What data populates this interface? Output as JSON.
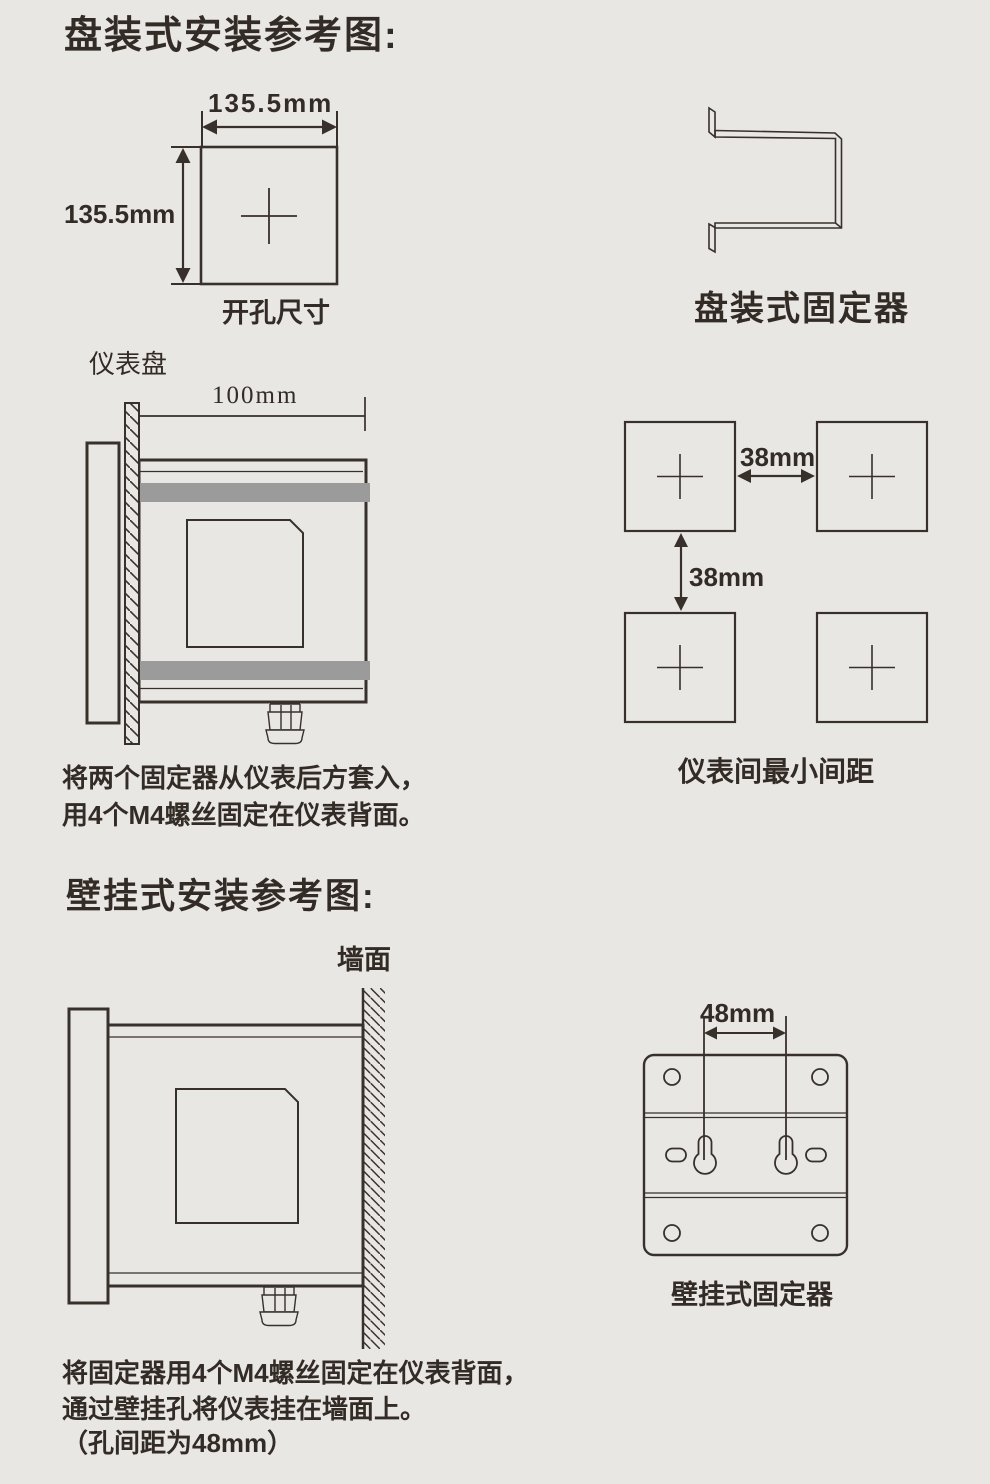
{
  "page": {
    "background": "#e9e7e4",
    "line_color": "#38302b",
    "bracket_bar_color": "#9b9b9b"
  },
  "panel_mount": {
    "title": "盘装式安装参考图:",
    "cutout": {
      "width": "135.5mm",
      "height": "135.5mm",
      "caption": "开孔尺寸"
    },
    "fixer_caption": "盘装式固定器",
    "side_view": {
      "panel_label": "仪表盘",
      "depth": "100mm"
    },
    "spacing": {
      "horizontal": "38mm",
      "vertical": "38mm",
      "caption": "仪表间最小间距"
    },
    "note": {
      "line1": "将两个固定器从仪表后方套入，",
      "line2": "用4个M4螺丝固定在仪表背面。"
    }
  },
  "wall_mount": {
    "title": "壁挂式安装参考图:",
    "wall_label": "墙面",
    "fixer": {
      "hole_spacing": "48mm",
      "caption": "壁挂式固定器"
    },
    "note": {
      "line1": "将固定器用4个M4螺丝固定在仪表背面，",
      "line2": "通过壁挂孔将仪表挂在墙面上。",
      "line3": "（孔间距为48mm）"
    }
  }
}
